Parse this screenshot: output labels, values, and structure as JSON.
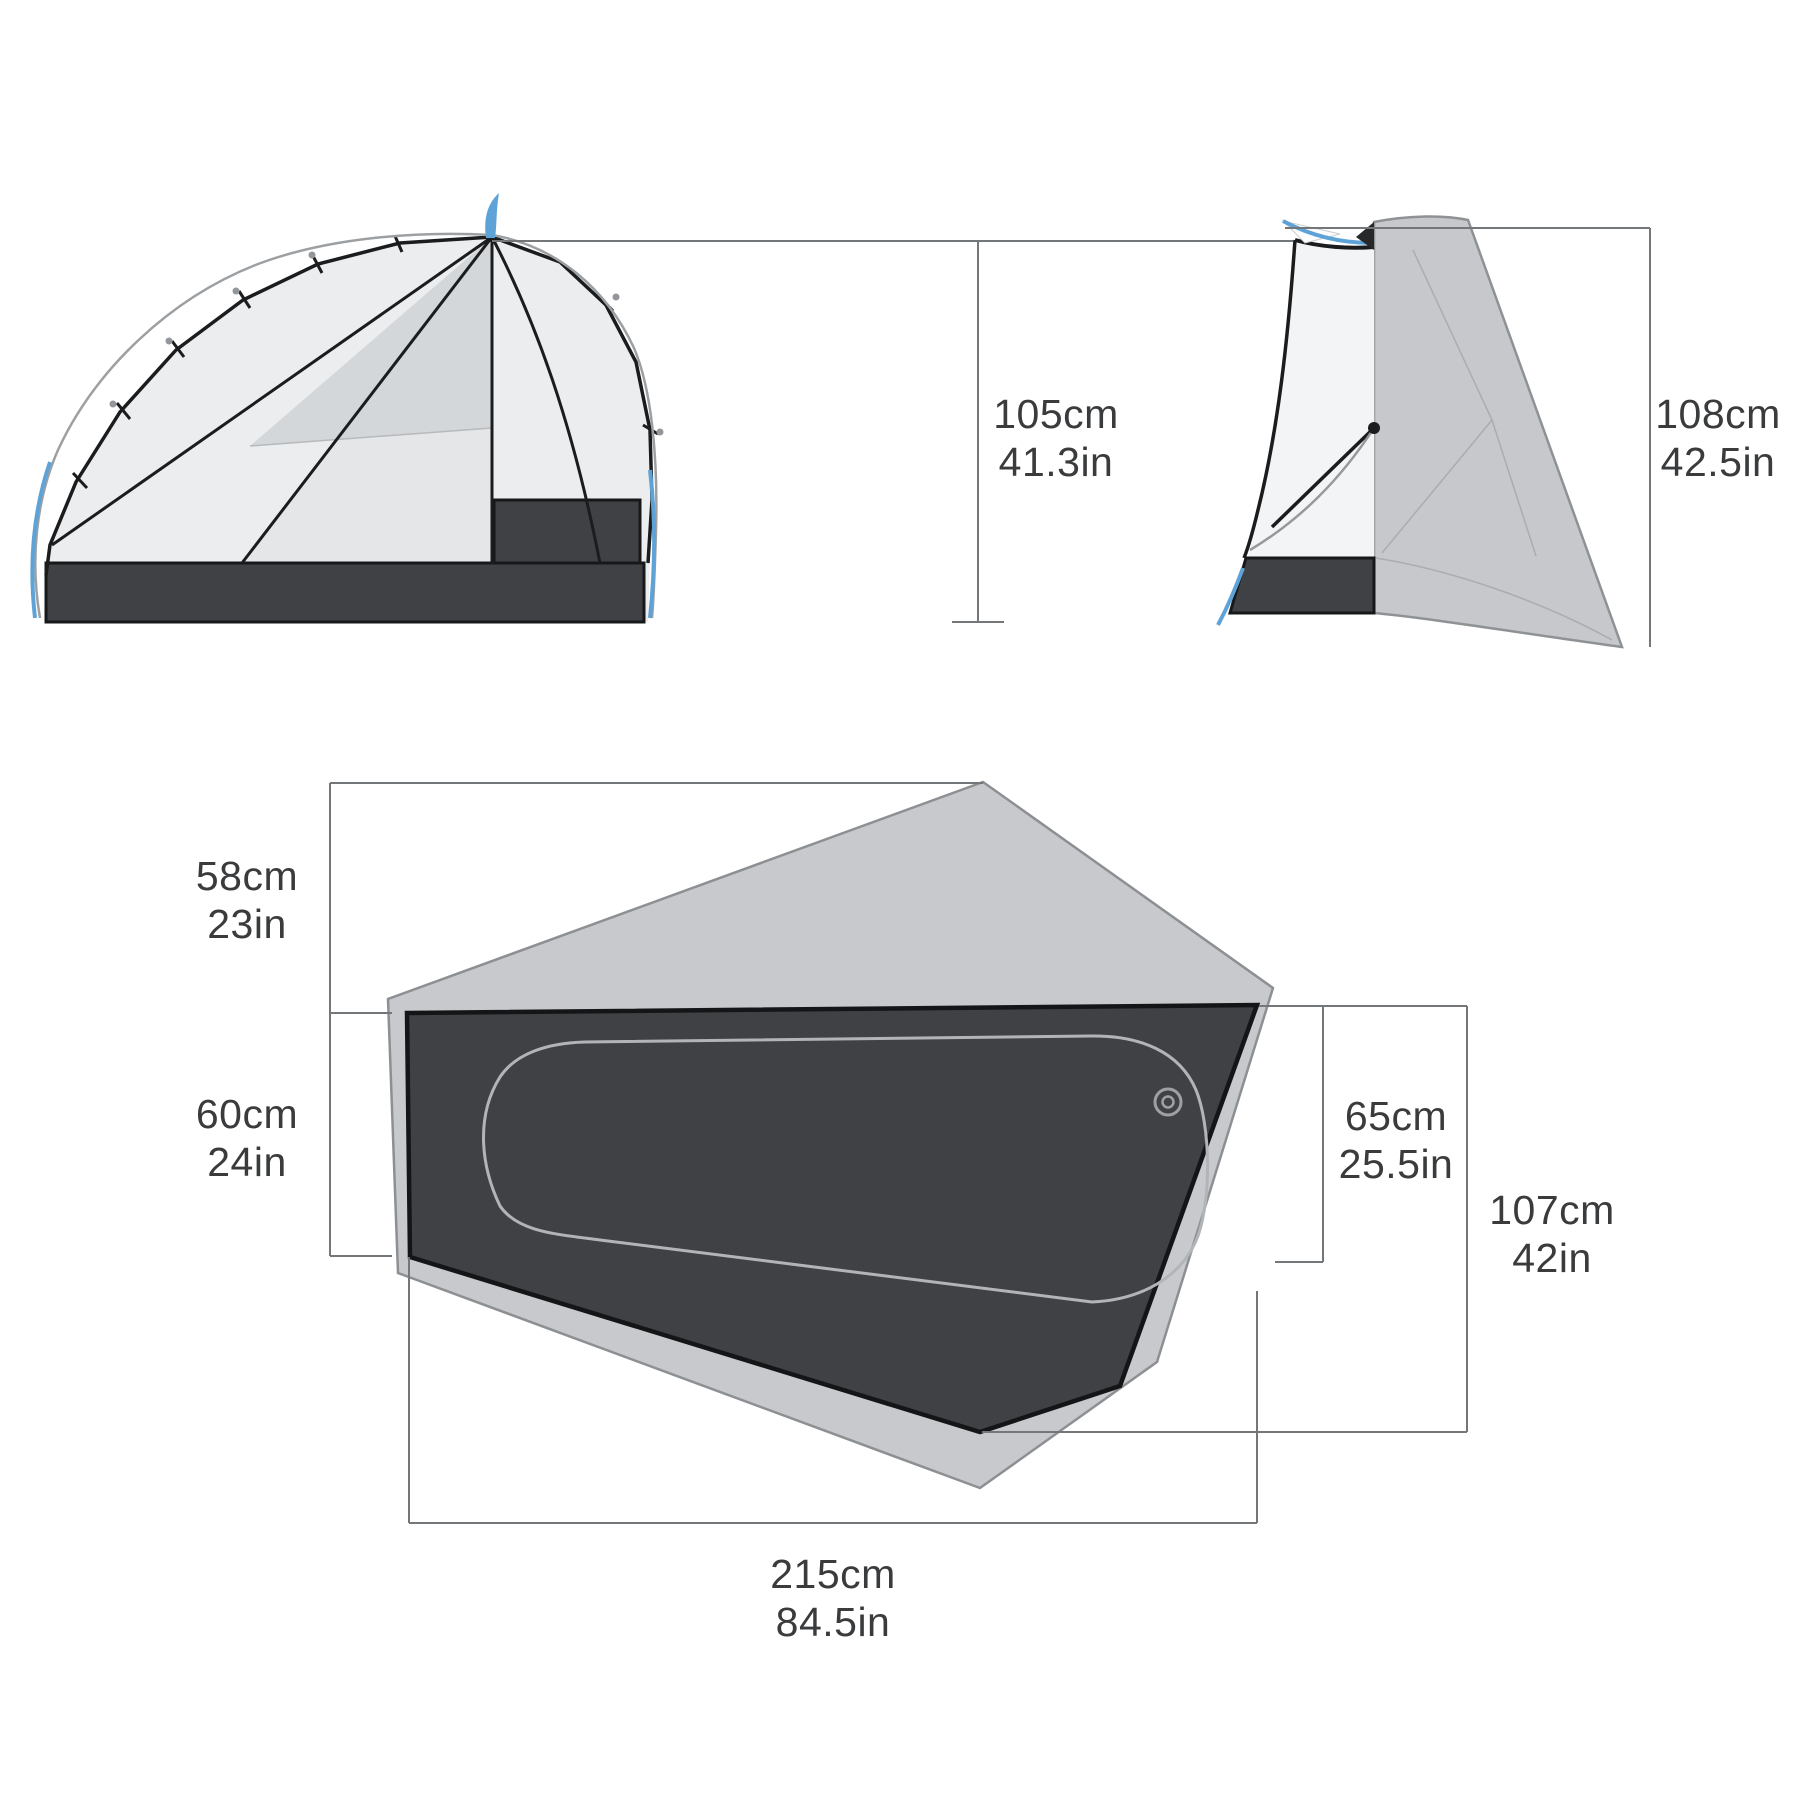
{
  "diagram_type": "tent-dimensions-spec",
  "views": {
    "side_view": {
      "name": "side-view-illustration"
    },
    "end_view": {
      "name": "end-view-illustration"
    },
    "floor_plan": {
      "name": "floor-plan-illustration"
    }
  },
  "dimensions": {
    "side_height": {
      "metric": "105cm",
      "imperial": "41.3in"
    },
    "end_height": {
      "metric": "108cm",
      "imperial": "42.5in"
    },
    "vestibule_depth": {
      "metric": "58cm",
      "imperial": "23in"
    },
    "head_width": {
      "metric": "60cm",
      "imperial": "24in"
    },
    "foot_width": {
      "metric": "65cm",
      "imperial": "25.5in"
    },
    "max_width": {
      "metric": "107cm",
      "imperial": "42in"
    },
    "floor_length": {
      "metric": "215cm",
      "imperial": "84.5in"
    }
  },
  "colors": {
    "background": "#ffffff",
    "accent_pole_blue": "#5ea3d8",
    "fly_gray": "#c6c8cb",
    "panel_light": "#ecedef",
    "panel_shaded": "#d4d7da",
    "floor_dark": "#404145",
    "outline_black": "#1b1c1e",
    "dimension_line": "#74777a",
    "label_text": "#3a3b3d",
    "pad_outline": "#b2b5b8"
  }
}
